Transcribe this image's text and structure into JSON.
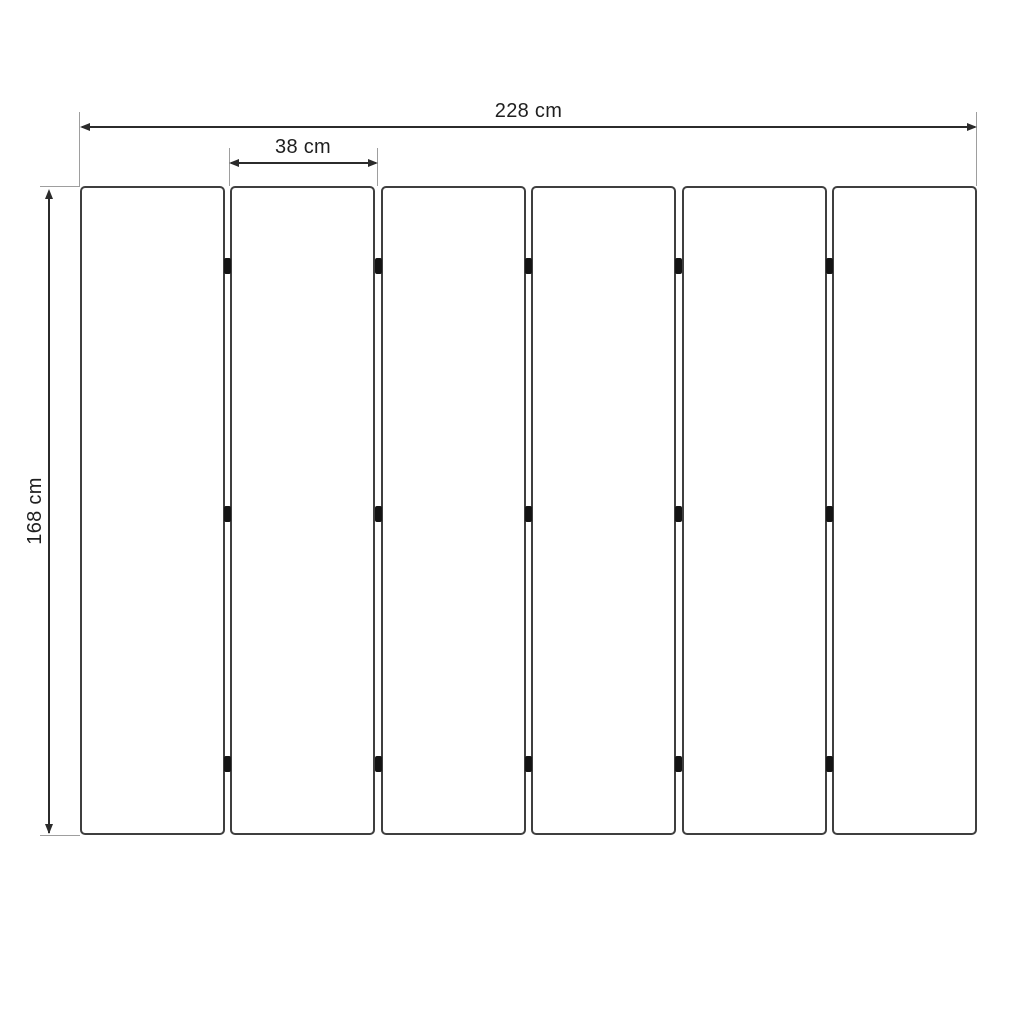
{
  "drawing": {
    "title": "folding-panel-technical-drawing",
    "panels": {
      "count": 6,
      "junction_count": 5,
      "hinges_per_junction": 3
    },
    "dimensions": {
      "total_width": {
        "label": "228 cm"
      },
      "panel_width": {
        "label": "38 cm"
      },
      "height": {
        "label": "168 cm"
      }
    },
    "colors": {
      "background": "#ffffff",
      "panel_border": "#3f3f3f",
      "panel_fill": "#ffffff",
      "hinge": "#141414",
      "dimension_line": "#2b2b2b",
      "extension_line": "#9e9e9e",
      "text": "#1f1f1f"
    }
  }
}
